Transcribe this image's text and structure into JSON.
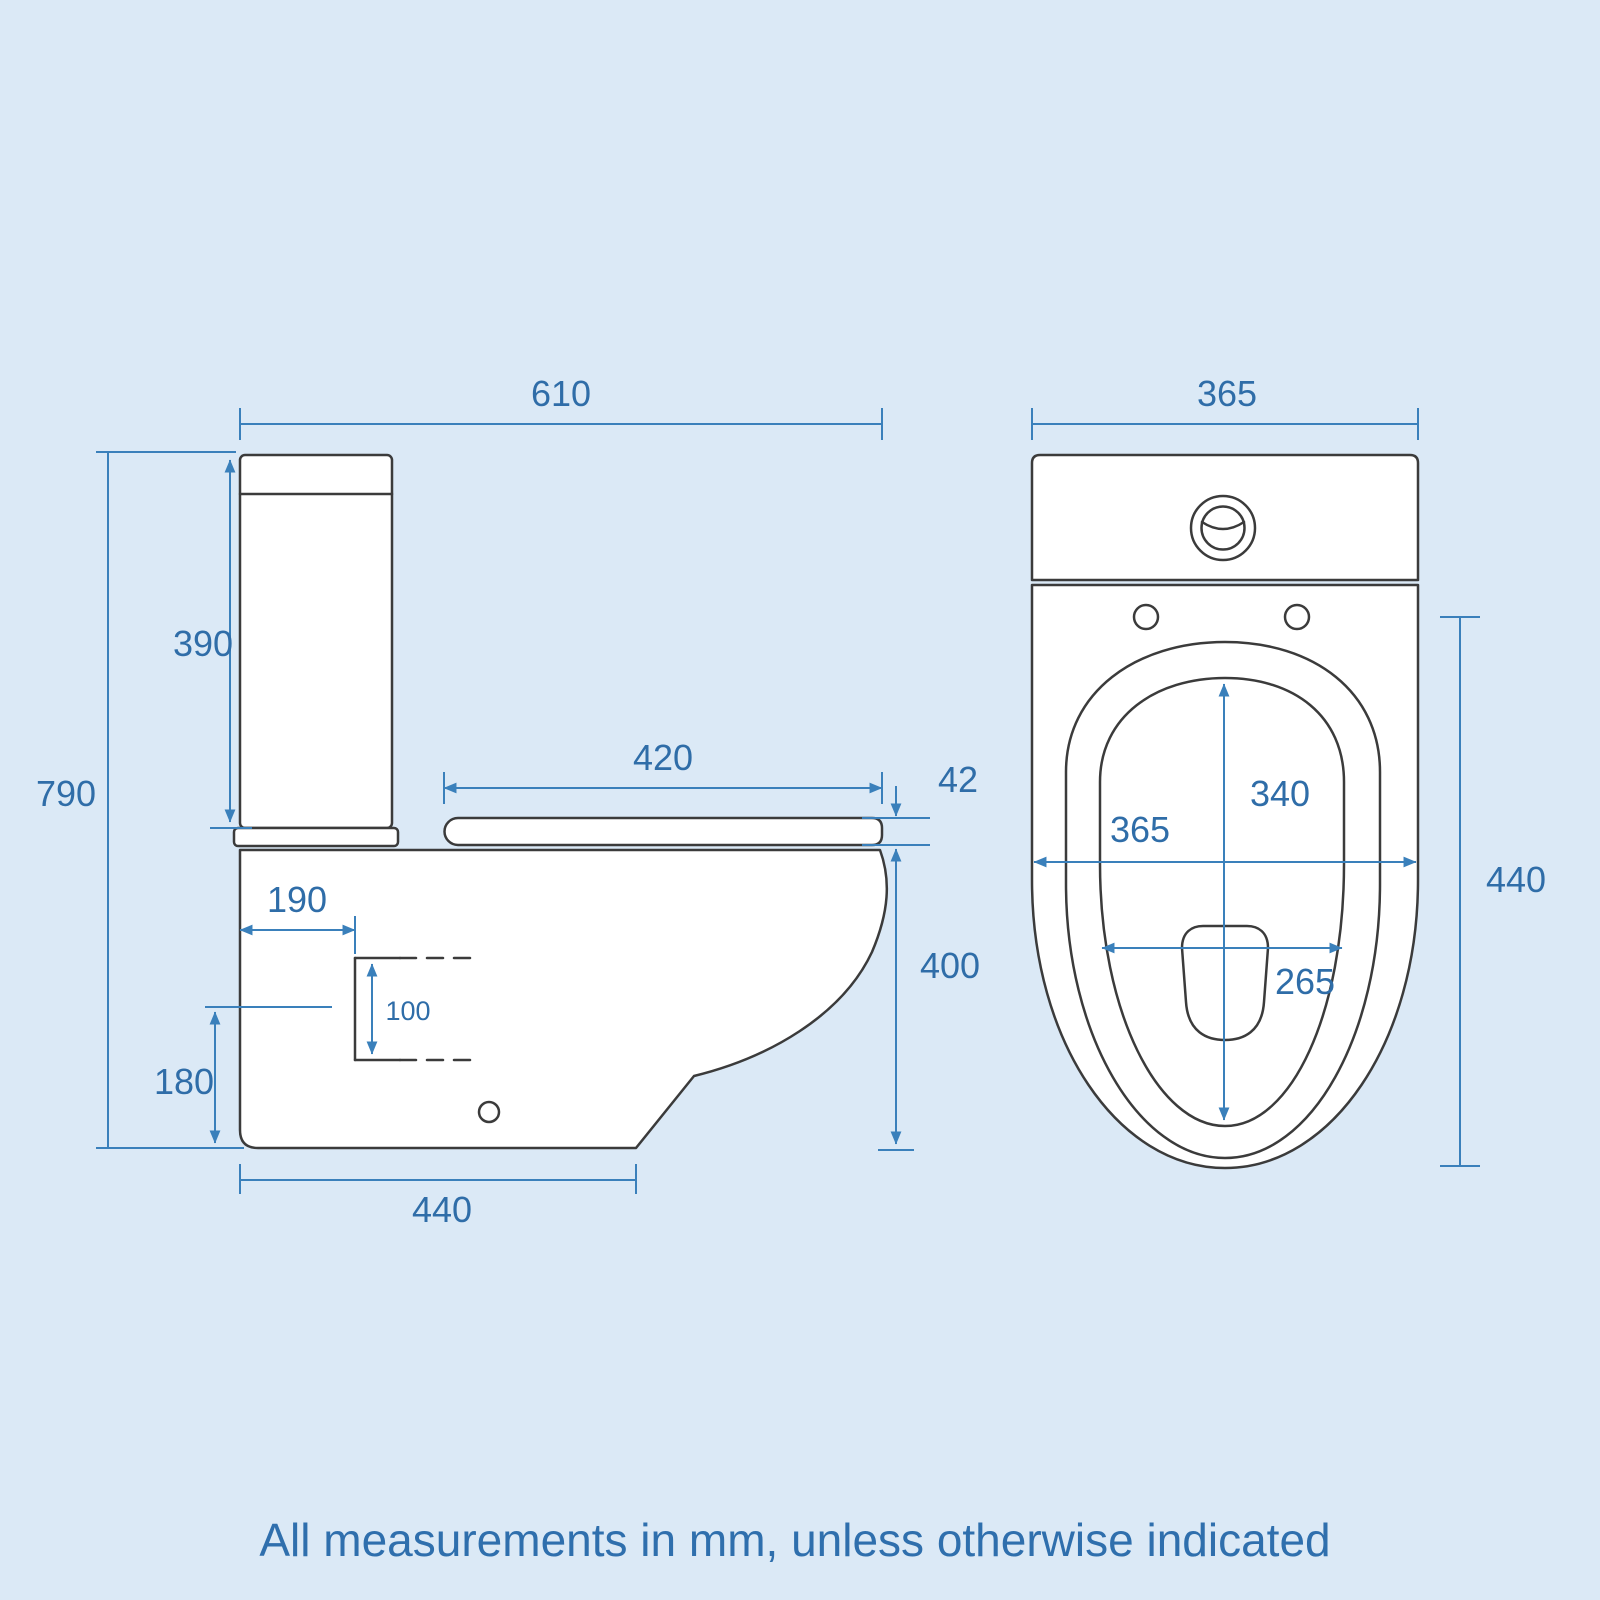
{
  "note": {
    "text": "All measurements in mm, unless otherwise indicated"
  },
  "colors": {
    "background": "#dbe9f6",
    "drawing_outline": "#3b3b3b",
    "dimension_line": "#3a80bb",
    "dimension_text": "#2f6da8",
    "fixture_fill": "#ffffff"
  },
  "side_view": {
    "name": "Side elevation of close coupled toilet",
    "dims": {
      "overall_depth": "610",
      "cistern_height": "390",
      "overall_height": "790",
      "seat_length": "420",
      "seat_thickness": "42",
      "outlet_setback": "190",
      "outlet_size": "100",
      "outlet_centre_height": "180",
      "rim_height": "400",
      "base_depth": "440"
    }
  },
  "front_view": {
    "name": "Front elevation of close coupled toilet",
    "dims": {
      "cistern_width": "365",
      "bowl_opening_length": "340",
      "pan_width": "365",
      "bowl_opening_width": "265",
      "seat_length_front": "440"
    }
  }
}
